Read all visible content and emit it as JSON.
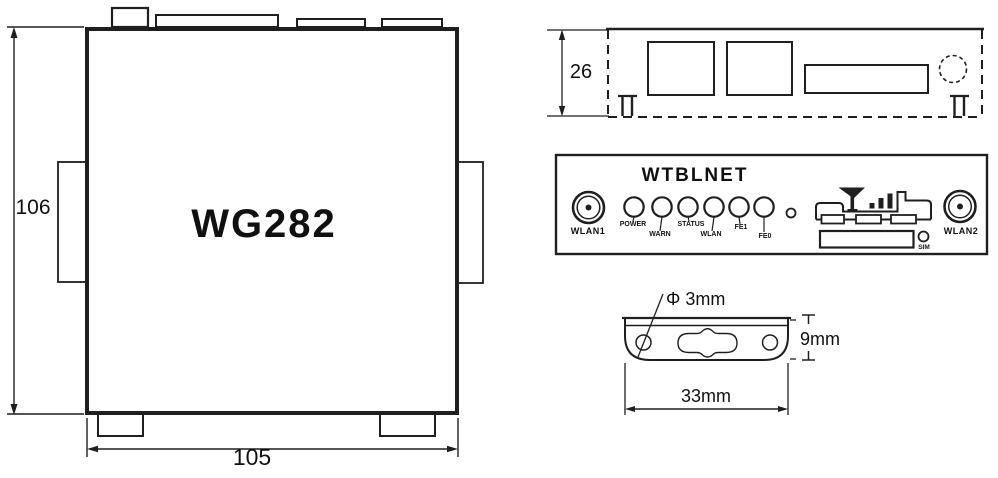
{
  "colors": {
    "ink": "#1f1f1f",
    "paper": "#ffffff"
  },
  "top_view": {
    "model": "WG282",
    "dim_height": "106",
    "dim_width": "105"
  },
  "rear_view": {
    "dim_height": "26"
  },
  "front_panel": {
    "title": "WTBLNET",
    "wlan1": "WLAN1",
    "wlan2": "WLAN2",
    "leds": [
      "POWER",
      "WARN",
      "STATUS",
      "WLAN",
      "FE1",
      "FE0"
    ],
    "sim": "SIM"
  },
  "bracket": {
    "dim_hole": "Φ 3mm",
    "dim_height": "9mm",
    "dim_width": "33mm"
  },
  "icons": {
    "antenna": "antenna-icon",
    "signal_bars": "signal-bars-icon"
  }
}
